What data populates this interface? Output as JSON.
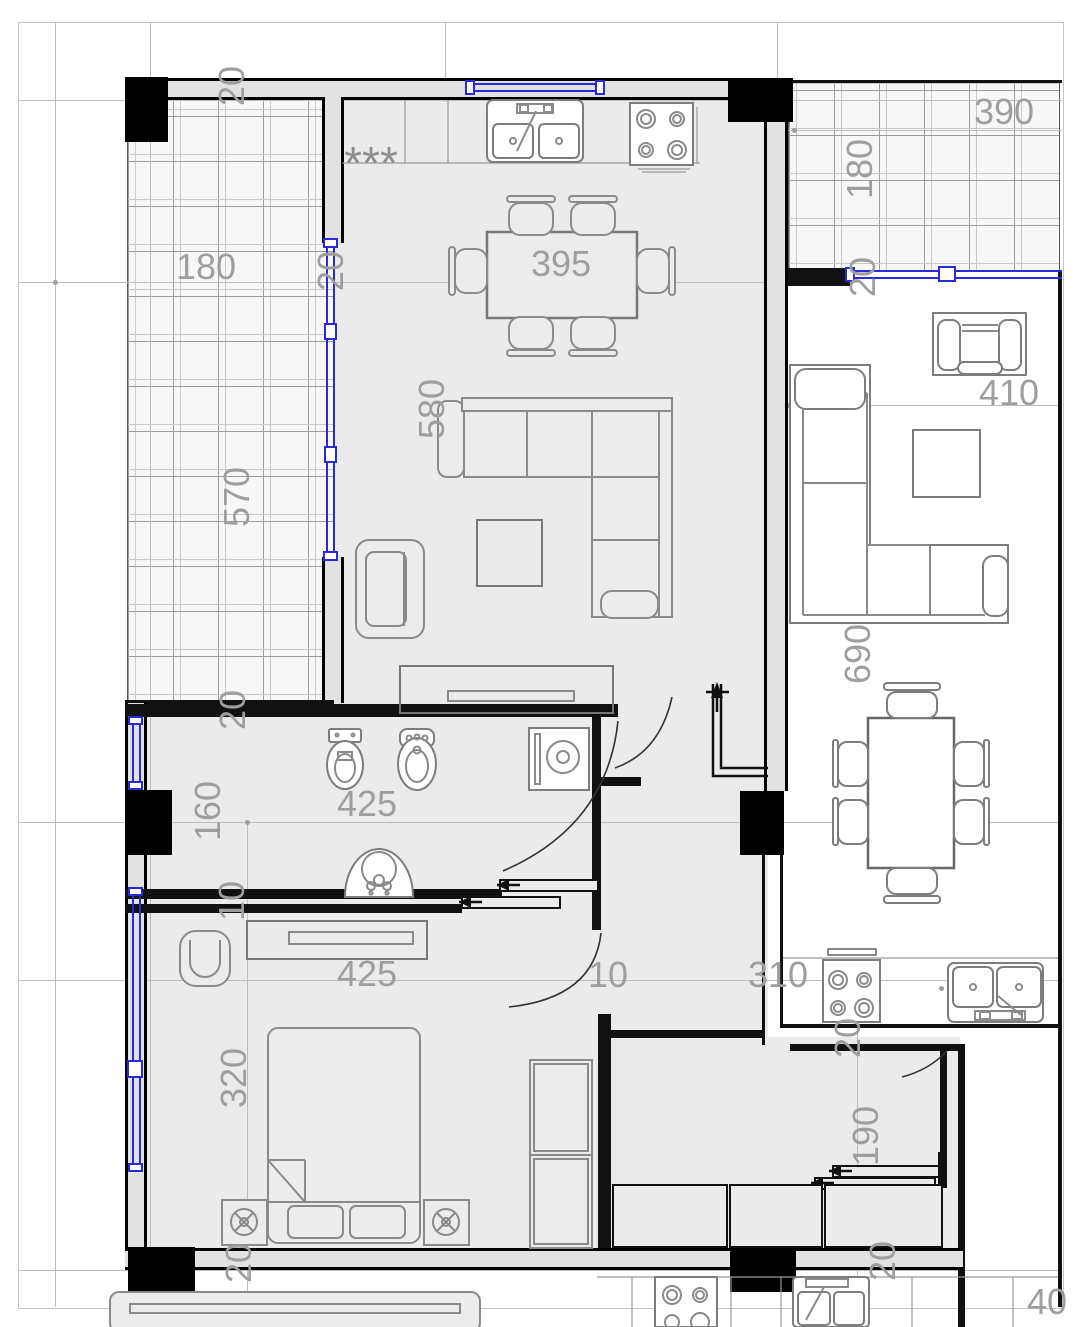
{
  "colors": {
    "window_accent": "#2a2ad4",
    "wall": "#000000",
    "floor_left_unit": "#ebebeb",
    "dim_text": "#9e9e9e"
  },
  "symbols": {
    "fridge_marker": "***"
  },
  "dims": {
    "top_wall": "20",
    "balcony_left_width": "180",
    "balcony_left_wall": "20",
    "dining_width": "395",
    "balcony_left_depth": "570",
    "sofa_width": "580",
    "balcony_right_width": "390",
    "balcony_right_depth": "180",
    "balcony_right_wall": "20",
    "living_right_width": "410",
    "living_right_depth": "690",
    "bath_wall": "20",
    "bath_depth": "160",
    "bath_width": "425",
    "partition_gap": "10",
    "bedroom_width": "425",
    "hall_gap": "10",
    "kitchen_right_width": "310",
    "bedroom_depth": "320",
    "bottom_wall_left": "20",
    "corridor_wall_top": "20",
    "corridor_width": "190",
    "corridor_wall_bottom": "20",
    "corner_partial": "40"
  }
}
